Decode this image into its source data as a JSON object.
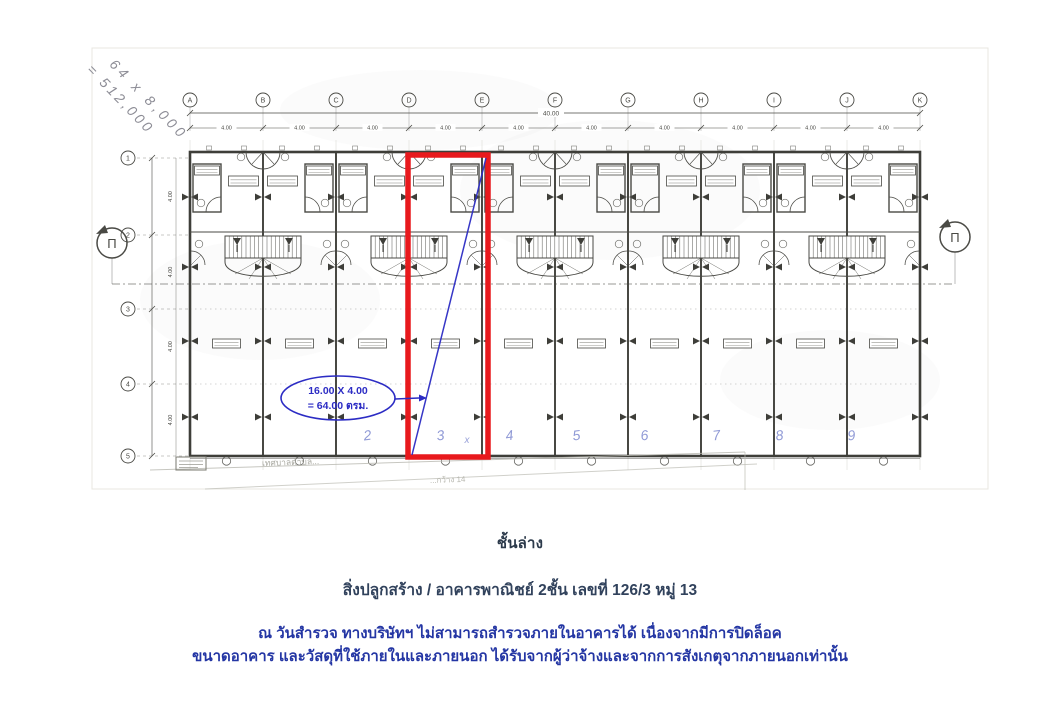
{
  "figure": {
    "colors": {
      "ink": "#4a4a45",
      "wall": "#3e3e39",
      "faint": "#c9c9c1",
      "red": "#e8191d",
      "blue": "#2c2cc4",
      "pencil": "#8d8d96",
      "hand_blue": "#6c79c9"
    },
    "grid": {
      "columns": [
        "A",
        "B",
        "C",
        "D",
        "E",
        "F",
        "G",
        "H",
        "I",
        "J",
        "K"
      ],
      "rows": [
        "1",
        "2",
        "3",
        "4",
        "5"
      ],
      "bay_dim": "4.00",
      "overall_dim": "40.00",
      "depth_dim": "4.00"
    },
    "section_marker_label": "Π",
    "annotation": {
      "line1": "16.00 X 4.00",
      "line2": "= 64.00 ตรม."
    },
    "handwritten_note": {
      "line1": "64 x 8,000",
      "line2": "= 512,000"
    },
    "unit_numbers": [
      "2",
      "3",
      "4",
      "5",
      "6",
      "7",
      "8",
      "9"
    ],
    "red_unit_mark": "x",
    "faint_text_municipality": "เทศบาลตำบล...",
    "faint_text_road": "...กว้าง 14"
  },
  "captions": {
    "floor_label": "ชั้นล่าง",
    "building_label": "สิ่งปลูกสร้าง / อาคารพาณิชย์ 2ชั้น เลขที่ 126/3 หมู่ 13",
    "note_line1": "ณ วันสำรวจ ทางบริษัทฯ ไม่สามารถสำรวจภายในอาคารได้ เนื่องจากมีการปิดล็อค",
    "note_line2": "ขนาดอาคาร และวัสดุที่ใช้ภายในและภายนอก ได้รับจากผู้ว่าจ้างและจากการสังเกตุจากภายนอกเท่านั้น"
  }
}
